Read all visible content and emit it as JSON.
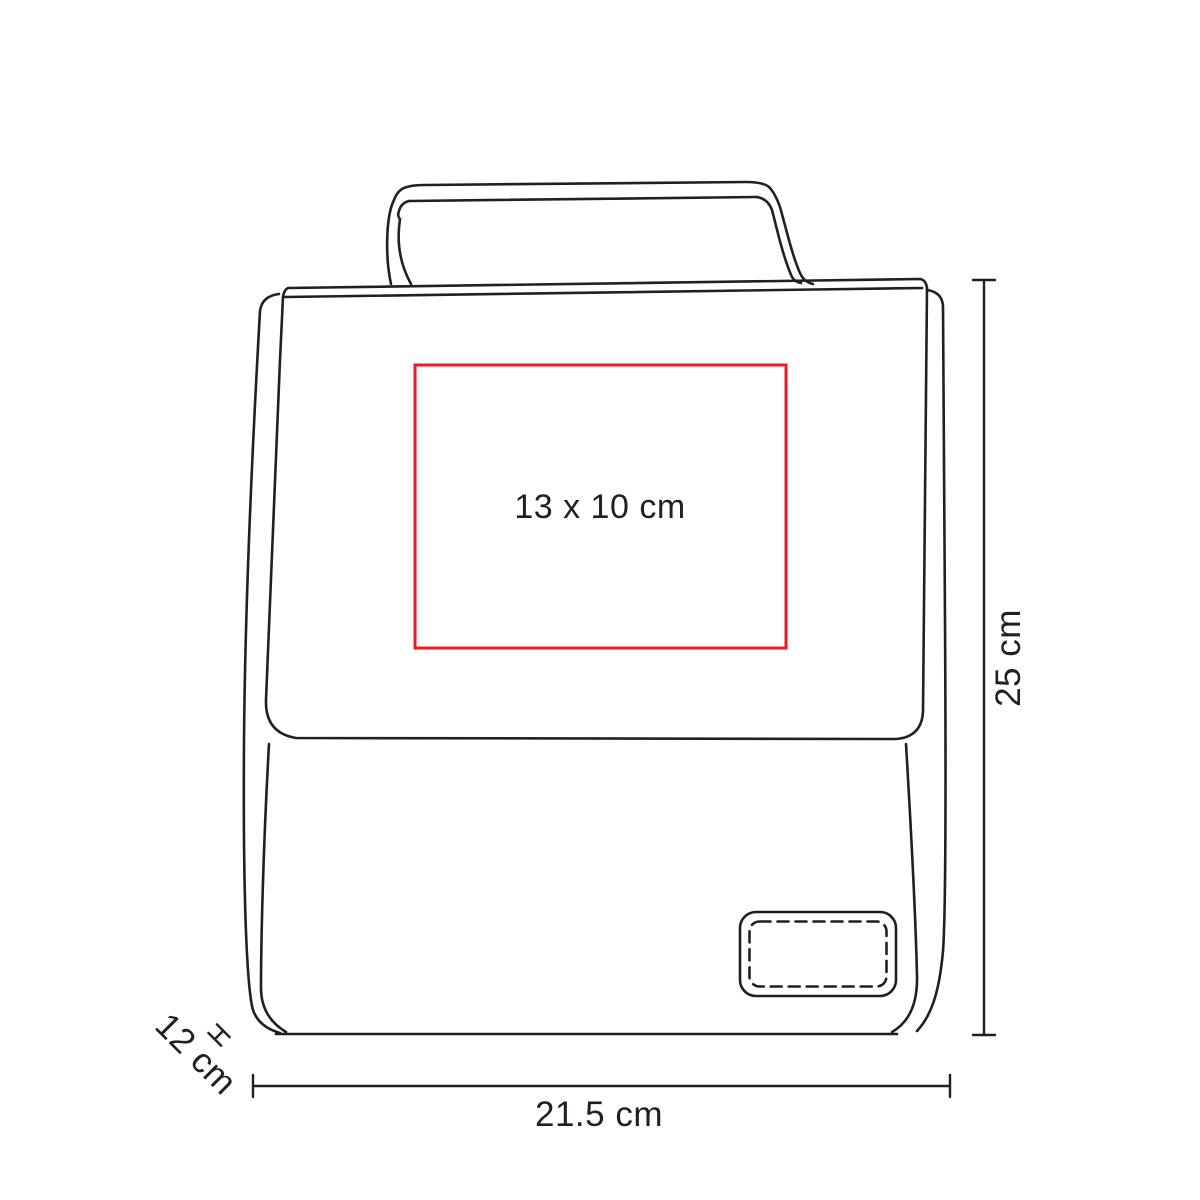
{
  "imprint_area": {
    "size_label": "13 x 10 cm"
  },
  "dimensions": {
    "height_label": "25 cm",
    "width_label": "21.5 cm",
    "depth_label": "12 cm"
  },
  "colors": {
    "line": "#231f20",
    "imprint_red": "#ED1C24",
    "background": "#ffffff"
  }
}
